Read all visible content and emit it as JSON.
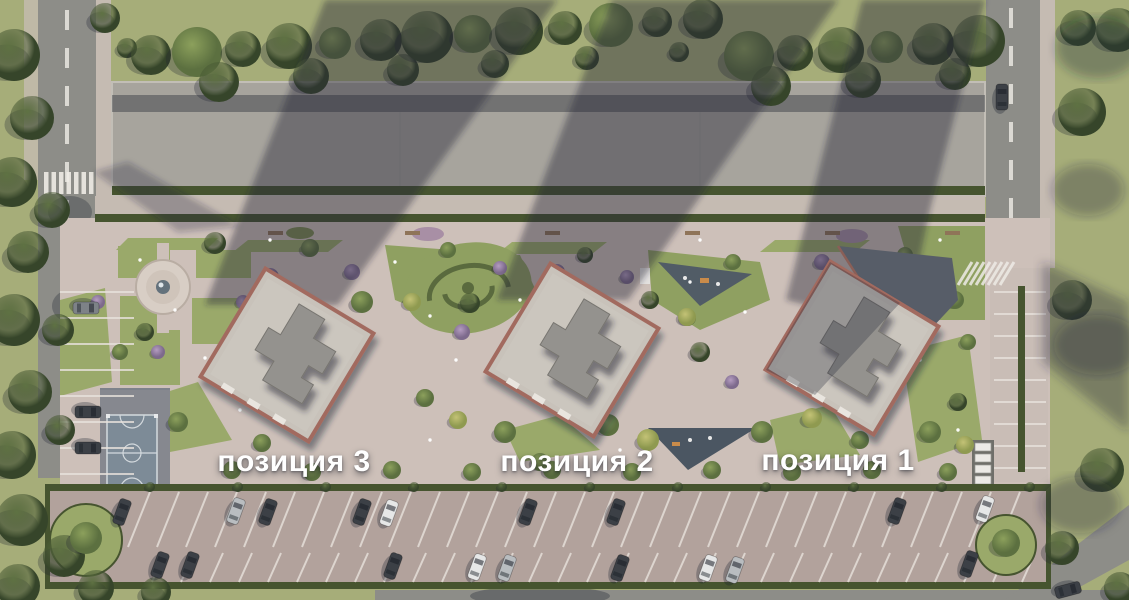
{
  "view": {
    "type": "aerial-masterplan-render"
  },
  "buildings": [
    {
      "id": "position-3",
      "label": "позиция 3"
    },
    {
      "id": "position-2",
      "label": "позиция 2"
    },
    {
      "id": "position-1",
      "label": "позиция 1"
    }
  ],
  "palette": {
    "grass": "#a6ad79",
    "lawn": "#9aa96a",
    "lawn_dark": "#8fa061",
    "road": "#8d8d88",
    "sidewalk": "#c5bbb2",
    "paving": "#cdc0b9",
    "parking_lot": "#b2a29c",
    "long_roof": "#a7a49d",
    "hedge": "#46542f",
    "roof": "#c8c2ba",
    "roof_edge": "#a26b5e",
    "tower": "#94928e",
    "court": "#7d8b97",
    "rubber_pad": "#4b5662",
    "shadow": "rgba(36,40,56,0.42)",
    "label_color": "#ffffff"
  }
}
